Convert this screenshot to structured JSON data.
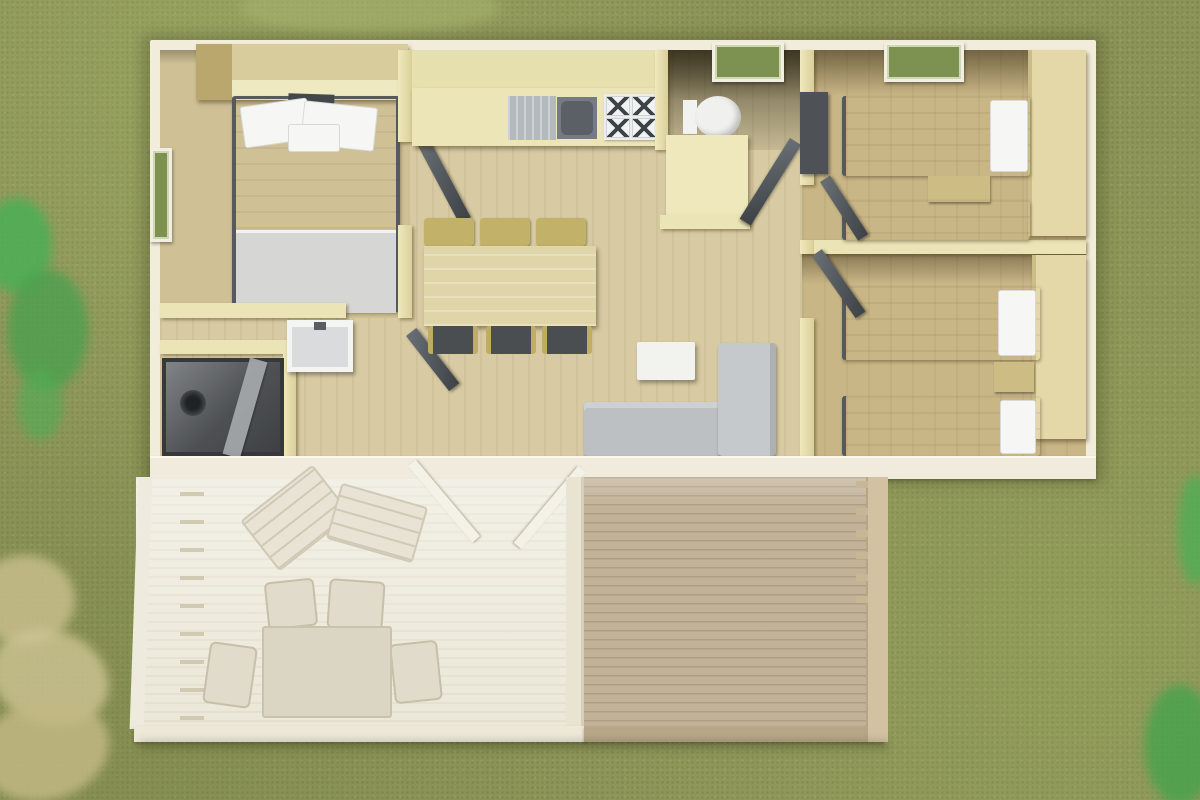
{
  "scene": {
    "title": "Mobile home floor plan – top-down 3D render",
    "environment": {
      "ground": "grass-lawn",
      "plants": [
        "green-shrub-left-edge",
        "dry-fern-bottom-left",
        "green-plant-right-edge",
        "green-plant-bottom-right"
      ]
    },
    "palette": {
      "grass": "#8c9457",
      "outer_wall": "#f2edda",
      "inner_wall": "#ebe4b6",
      "floor_wood": "#d8cba3",
      "floor_tan": "#c9b687",
      "bed_linen": "#e9e9e7",
      "door_gray": "#4e5357",
      "sofa_gray": "#c0c3c5",
      "deck_wood": "#c2b298",
      "terrace_pale": "#e6e1cd"
    },
    "rooms": [
      {
        "name": "master-bedroom",
        "position": "top-left",
        "items": [
          "double-bed",
          "wardrobe",
          "side-window"
        ]
      },
      {
        "name": "kitchen",
        "position": "top-center",
        "items": [
          "counter",
          "drainer",
          "sink",
          "hob-4-burners",
          "knob-strip"
        ]
      },
      {
        "name": "dining-area",
        "position": "center-left",
        "items": [
          "dining-table",
          "three-chairs-top",
          "three-chairs-bottom"
        ]
      },
      {
        "name": "living-area",
        "position": "center",
        "items": [
          "l-shaped-sofa",
          "coffee-table"
        ]
      },
      {
        "name": "toilet-room",
        "position": "center-top",
        "items": [
          "wc",
          "cabinet",
          "top-window"
        ]
      },
      {
        "name": "bathroom",
        "position": "bottom-left",
        "items": [
          "shower",
          "glass-panel",
          "washbasin"
        ]
      },
      {
        "name": "bedroom-2",
        "position": "top-right",
        "items": [
          "single-bed",
          "single-bed",
          "nightstand",
          "tall-wardrobe",
          "dark-closet",
          "top-window"
        ]
      },
      {
        "name": "bedroom-3",
        "position": "bottom-right",
        "items": [
          "single-bed",
          "single-bed",
          "nightstand",
          "tall-wardrobe"
        ]
      },
      {
        "name": "covered-terrace",
        "position": "bottom-left-outside",
        "items": [
          "lounger",
          "lounger",
          "garden-table",
          "garden-chair",
          "garden-chair",
          "garden-chair",
          "garden-chair",
          "open-sliding-doors",
          "canopy-frame"
        ]
      },
      {
        "name": "open-deck",
        "position": "bottom-right-outside",
        "items": [
          "plank-floor",
          "side-railing-with-posts"
        ]
      }
    ],
    "doors": [
      "master-bedroom-door",
      "bathroom-door",
      "toilet-door",
      "bedroom-2-door",
      "bedroom-3-door"
    ],
    "windows": [
      "master-left-window",
      "toilet-top-window",
      "bedroom-2-top-window"
    ]
  }
}
